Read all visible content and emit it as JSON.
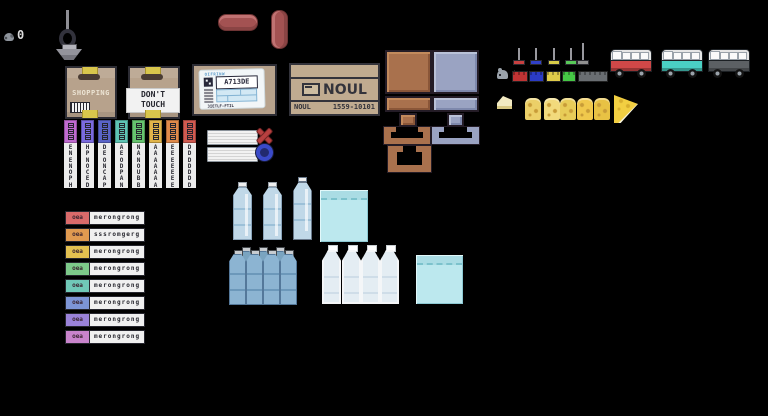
{
  "hud": {
    "count": "0"
  },
  "icons": {
    "mouse": "mouse-icon",
    "shovel": "shovel-icon",
    "x": "x-mark-icon",
    "o": "circle-mark-icon"
  },
  "boxes": {
    "shopping": {
      "label": "SHOPPING"
    },
    "dont_touch": {
      "line1": "DON'T",
      "line2": "TOUCH"
    },
    "shipping": {
      "header": "OIFRINW",
      "code": "A713DE",
      "footer": "3IETLF-FTIL"
    },
    "noul": {
      "logo": "NOUL",
      "brand": "NOUL",
      "code": "1559-10101"
    }
  },
  "newspapers": [
    {
      "color": "#c06ad0",
      "text": "ENENOPH"
    },
    {
      "color": "#7a6ade",
      "text": "HPNOCED"
    },
    {
      "color": "#5a64c8",
      "text": "DEONCAP"
    },
    {
      "color": "#5ec4b4",
      "text": "AEODPAN"
    },
    {
      "color": "#66c46e",
      "text": "NANOUBB"
    },
    {
      "color": "#e0b44a",
      "text": "AAAAAAA"
    },
    {
      "color": "#e08a4a",
      "text": "EEEEEEE"
    },
    {
      "color": "#d05a50",
      "text": "DDDDDDD"
    }
  ],
  "labels": [
    {
      "badge": "oea",
      "color": "#d96a6a",
      "text": "merongrong"
    },
    {
      "badge": "oea",
      "color": "#e09a50",
      "text": "sssromgerg"
    },
    {
      "badge": "oea",
      "color": "#e3c050",
      "text": "merongrong"
    },
    {
      "badge": "oea",
      "color": "#7dc98a",
      "text": "merongrong"
    },
    {
      "badge": "oea",
      "color": "#70c9b8",
      "text": "merongrong"
    },
    {
      "badge": "oea",
      "color": "#7d95d6",
      "text": "merongrong"
    },
    {
      "badge": "oea",
      "color": "#9a82d9",
      "text": "merongrong"
    },
    {
      "badge": "oea",
      "color": "#c984cc",
      "text": "merongrong"
    }
  ],
  "pins": [
    "#c84040",
    "#3040c8",
    "#d8cc48",
    "#58c858",
    "#909090"
  ],
  "bricks": [
    "#c03434",
    "#2b3bc4",
    "#e0cc4a",
    "#46c846",
    "#6a6e72"
  ],
  "vans": [
    "#d04848",
    "#4ad0c4",
    "#5c6064"
  ],
  "cheese_shades": [
    "#ecd068",
    "#f2da7c",
    "#e8cc58",
    "#f0c84c",
    "#e8c244"
  ]
}
